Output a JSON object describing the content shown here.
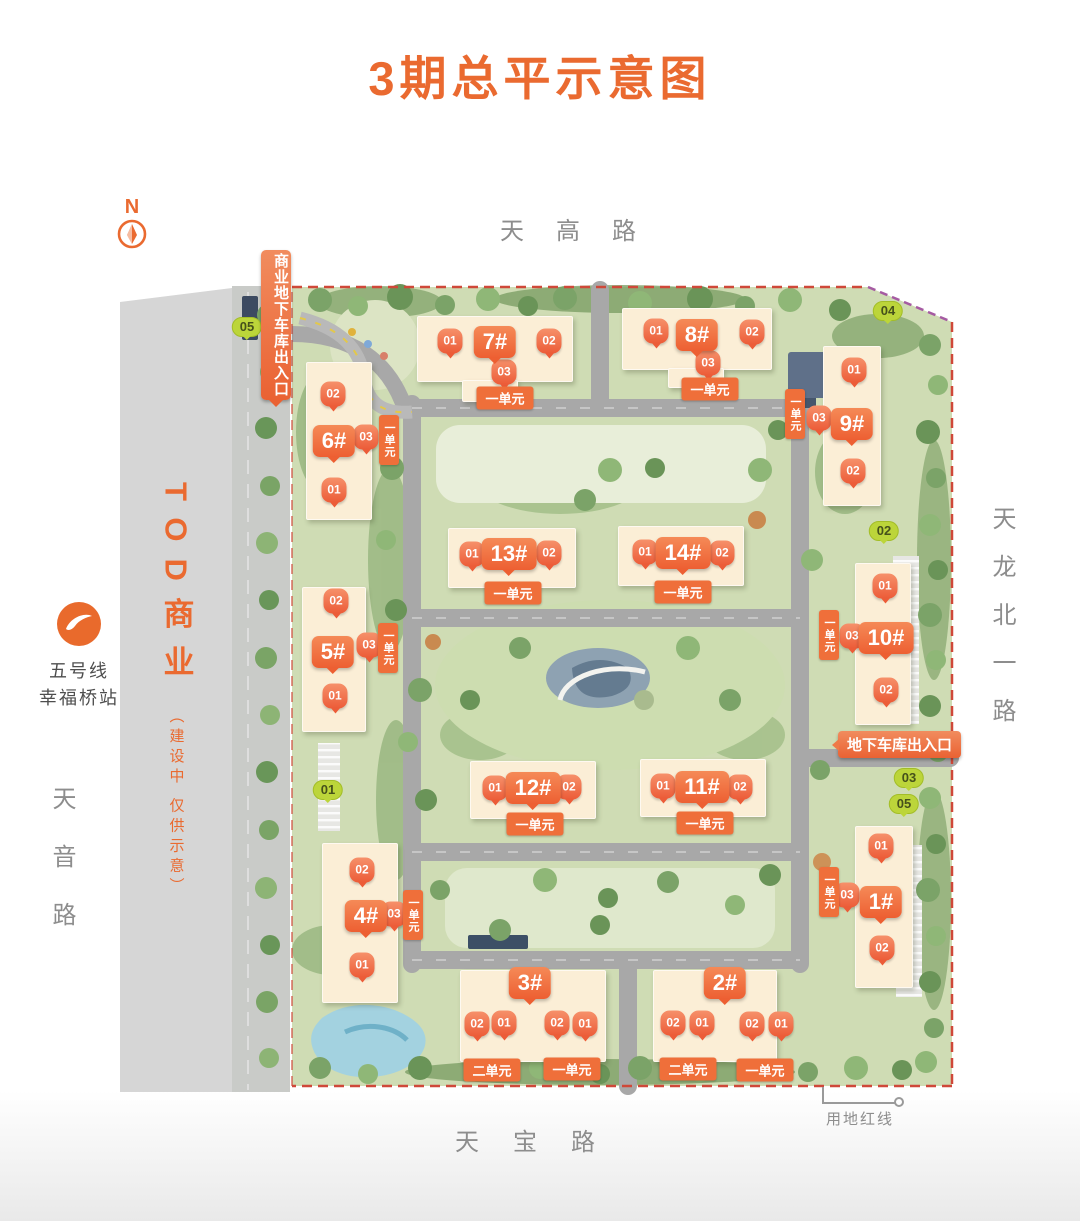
{
  "title": "3期总平示意图",
  "compass": {
    "label": "N"
  },
  "roads": {
    "top": "天高路",
    "right": "天龙北一路",
    "left": "天音路",
    "bottom": "天宝路"
  },
  "metro": {
    "line": "五号线",
    "station": "幸福桥站"
  },
  "tod": {
    "title": "TOD商业",
    "note": "（建设中 仅供示意）"
  },
  "banners": {
    "commercial_garage": "商业地下车库出入口",
    "garage": "地下车库出入口"
  },
  "boundary": {
    "label": "用地红线"
  },
  "colors": {
    "accent": "#EA6A30",
    "pin": "#EC5C38",
    "building": "#FBEED6",
    "green_marker": "#BCD53A",
    "boundary_red": "#CF4839",
    "road_text": "#8D8D8D"
  },
  "green_markers": [
    {
      "label": "05",
      "x": 247,
      "y": 327
    },
    {
      "label": "04",
      "x": 888,
      "y": 311
    },
    {
      "label": "02",
      "x": 884,
      "y": 531
    },
    {
      "label": "01",
      "x": 328,
      "y": 790
    },
    {
      "label": "03",
      "x": 909,
      "y": 778
    },
    {
      "label": "05",
      "x": 904,
      "y": 804
    }
  ],
  "buildings": [
    {
      "name": "7#",
      "rects": [
        [
          417,
          316,
          156,
          66
        ],
        [
          462,
          380,
          56,
          22
        ]
      ],
      "label": {
        "x": 495,
        "y": 342
      },
      "pins": [
        {
          "t": "01",
          "x": 450,
          "y": 343
        },
        {
          "t": "02",
          "x": 549,
          "y": 343
        },
        {
          "t": "03",
          "x": 504,
          "y": 374
        }
      ],
      "banners": [
        {
          "t": "一单元",
          "x": 505,
          "y": 398
        }
      ]
    },
    {
      "name": "8#",
      "rects": [
        [
          622,
          308,
          150,
          62
        ],
        [
          668,
          368,
          56,
          20
        ]
      ],
      "label": {
        "x": 697,
        "y": 335
      },
      "pins": [
        {
          "t": "01",
          "x": 656,
          "y": 333
        },
        {
          "t": "02",
          "x": 752,
          "y": 334
        },
        {
          "t": "03",
          "x": 708,
          "y": 365
        }
      ],
      "banners": [
        {
          "t": "一单元",
          "x": 710,
          "y": 389
        }
      ]
    },
    {
      "name": "6#",
      "rects": [
        [
          306,
          362,
          66,
          158
        ]
      ],
      "label": {
        "x": 334,
        "y": 441
      },
      "pins": [
        {
          "t": "02",
          "x": 333,
          "y": 396
        },
        {
          "t": "03",
          "x": 366,
          "y": 439
        },
        {
          "t": "01",
          "x": 334,
          "y": 492
        }
      ],
      "banners": [
        {
          "t": "一单元",
          "x": 389,
          "y": 440,
          "v": true
        }
      ]
    },
    {
      "name": "5#",
      "rects": [
        [
          302,
          587,
          64,
          145
        ]
      ],
      "label": {
        "x": 333,
        "y": 652
      },
      "pins": [
        {
          "t": "02",
          "x": 336,
          "y": 603
        },
        {
          "t": "03",
          "x": 369,
          "y": 647
        },
        {
          "t": "01",
          "x": 335,
          "y": 698
        }
      ],
      "banners": [
        {
          "t": "一单元",
          "x": 388,
          "y": 648,
          "v": true
        }
      ]
    },
    {
      "name": "4#",
      "rects": [
        [
          322,
          843,
          76,
          160
        ]
      ],
      "label": {
        "x": 366,
        "y": 916
      },
      "pins": [
        {
          "t": "02",
          "x": 362,
          "y": 872
        },
        {
          "t": "03",
          "x": 394,
          "y": 916
        },
        {
          "t": "01",
          "x": 362,
          "y": 967
        }
      ],
      "banners": [
        {
          "t": "一单元",
          "x": 413,
          "y": 915,
          "v": true
        }
      ]
    },
    {
      "name": "9#",
      "rects": [
        [
          823,
          346,
          58,
          160
        ]
      ],
      "label": {
        "x": 852,
        "y": 424
      },
      "pins": [
        {
          "t": "01",
          "x": 854,
          "y": 372
        },
        {
          "t": "03",
          "x": 819,
          "y": 420
        },
        {
          "t": "02",
          "x": 853,
          "y": 473
        }
      ],
      "banners": [
        {
          "t": "一单元",
          "x": 795,
          "y": 414,
          "v": true
        }
      ]
    },
    {
      "name": "10#",
      "rects": [
        [
          855,
          563,
          56,
          162
        ]
      ],
      "label": {
        "x": 886,
        "y": 638
      },
      "pins": [
        {
          "t": "01",
          "x": 885,
          "y": 588
        },
        {
          "t": "03",
          "x": 852,
          "y": 638
        },
        {
          "t": "02",
          "x": 886,
          "y": 692
        }
      ],
      "banners": [
        {
          "t": "一单元",
          "x": 829,
          "y": 635,
          "v": true
        }
      ]
    },
    {
      "name": "1#",
      "rects": [
        [
          855,
          826,
          58,
          162
        ]
      ],
      "label": {
        "x": 881,
        "y": 902
      },
      "pins": [
        {
          "t": "01",
          "x": 881,
          "y": 848
        },
        {
          "t": "03",
          "x": 847,
          "y": 897
        },
        {
          "t": "02",
          "x": 882,
          "y": 950
        }
      ],
      "banners": [
        {
          "t": "一单元",
          "x": 829,
          "y": 892,
          "v": true
        }
      ]
    },
    {
      "name": "13#",
      "rects": [
        [
          448,
          528,
          128,
          60
        ]
      ],
      "label": {
        "x": 509,
        "y": 554
      },
      "pins": [
        {
          "t": "01",
          "x": 472,
          "y": 556
        },
        {
          "t": "02",
          "x": 549,
          "y": 555
        }
      ],
      "banners": [
        {
          "t": "一单元",
          "x": 513,
          "y": 593
        }
      ]
    },
    {
      "name": "14#",
      "rects": [
        [
          618,
          526,
          126,
          60
        ]
      ],
      "label": {
        "x": 683,
        "y": 553
      },
      "pins": [
        {
          "t": "01",
          "x": 645,
          "y": 554
        },
        {
          "t": "02",
          "x": 722,
          "y": 555
        }
      ],
      "banners": [
        {
          "t": "一单元",
          "x": 683,
          "y": 592
        }
      ]
    },
    {
      "name": "12#",
      "rects": [
        [
          470,
          761,
          126,
          58
        ]
      ],
      "label": {
        "x": 533,
        "y": 788
      },
      "pins": [
        {
          "t": "01",
          "x": 495,
          "y": 790
        },
        {
          "t": "02",
          "x": 569,
          "y": 789
        }
      ],
      "banners": [
        {
          "t": "一单元",
          "x": 535,
          "y": 824
        }
      ]
    },
    {
      "name": "11#",
      "rects": [
        [
          640,
          759,
          126,
          58
        ]
      ],
      "label": {
        "x": 702,
        "y": 787
      },
      "pins": [
        {
          "t": "01",
          "x": 663,
          "y": 788
        },
        {
          "t": "02",
          "x": 740,
          "y": 789
        }
      ],
      "banners": [
        {
          "t": "一单元",
          "x": 705,
          "y": 823
        }
      ]
    },
    {
      "name": "3#",
      "rects": [
        [
          460,
          970,
          146,
          92
        ]
      ],
      "label": {
        "x": 530,
        "y": 983
      },
      "pins": [
        {
          "t": "02",
          "x": 477,
          "y": 1026
        },
        {
          "t": "01",
          "x": 504,
          "y": 1025
        },
        {
          "t": "02",
          "x": 557,
          "y": 1025
        },
        {
          "t": "01",
          "x": 585,
          "y": 1026
        }
      ],
      "banners": [
        {
          "t": "二单元",
          "x": 492,
          "y": 1070
        },
        {
          "t": "一单元",
          "x": 572,
          "y": 1069
        }
      ]
    },
    {
      "name": "2#",
      "rects": [
        [
          653,
          970,
          124,
          92
        ]
      ],
      "label": {
        "x": 725,
        "y": 983
      },
      "pins": [
        {
          "t": "02",
          "x": 673,
          "y": 1025
        },
        {
          "t": "01",
          "x": 702,
          "y": 1025
        },
        {
          "t": "02",
          "x": 752,
          "y": 1026
        },
        {
          "t": "01",
          "x": 781,
          "y": 1026
        }
      ],
      "banners": [
        {
          "t": "二单元",
          "x": 688,
          "y": 1069
        },
        {
          "t": "一单元",
          "x": 765,
          "y": 1070
        }
      ]
    }
  ]
}
